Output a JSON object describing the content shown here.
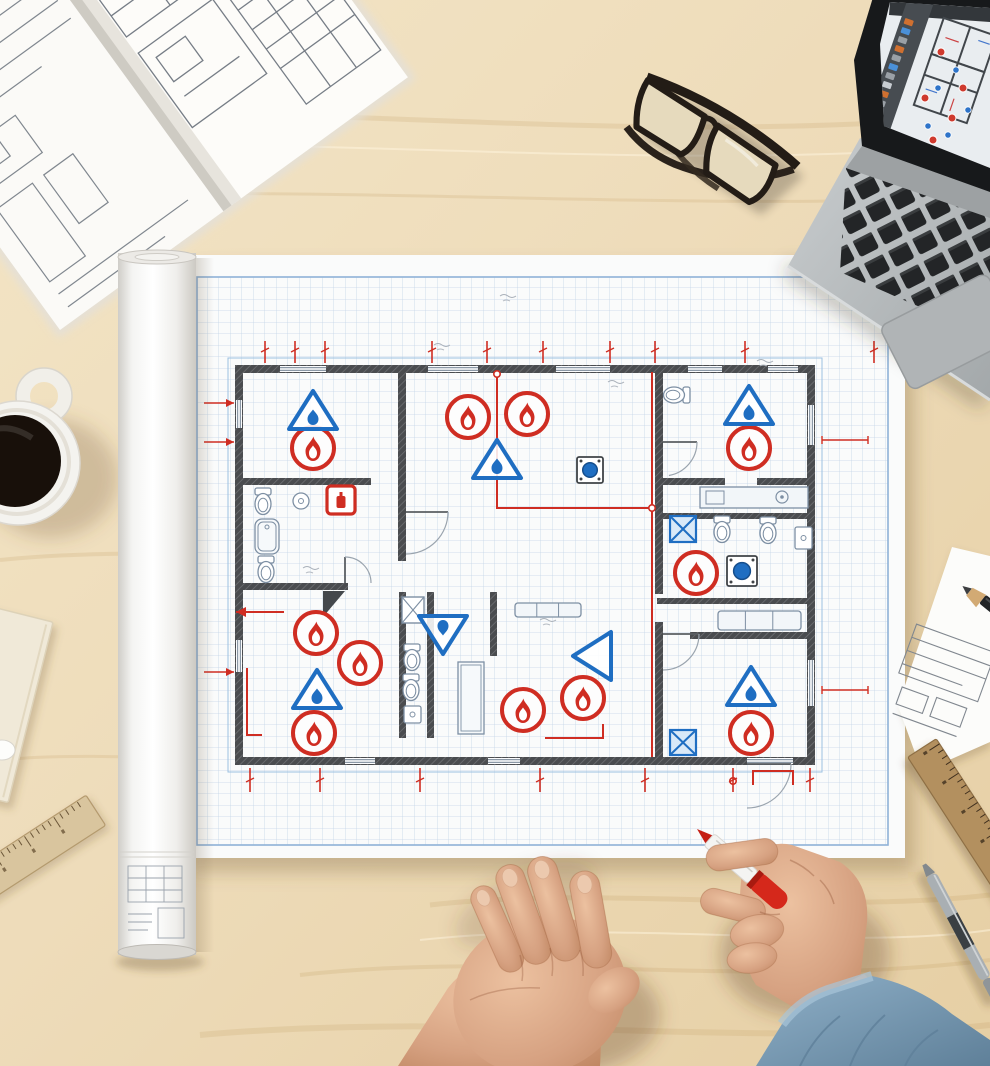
{
  "scene": {
    "description": "Top-down photograph of an architect's desk: fire-safety floor plan on grid paper, open specification book, laptop with CAD software, glasses, coffee mug, rolled blueprint tube, rulers, pencils, and two hands (one holding a red marker).",
    "visible_text": []
  },
  "palette": {
    "desk": "#eedcba",
    "desk_light": "#f5e8cb",
    "desk_dark": "#e2cba0",
    "paper": "#fafbfb",
    "grid": "#c5d5e7",
    "frame_blue": "#8fb2d8",
    "wall": "#4a4c4f",
    "wall_hatch": "#6e7073",
    "fixture": "#7d8fa3",
    "red": "#cf2d22",
    "blue": "#1f6ec2",
    "blue_fill": "#d9e9f8",
    "skin": "#d6a181",
    "skin_light": "#ecc1a0",
    "skin_shadow": "#bf8661",
    "denim": "#7fa0ba",
    "denim_dark": "#6d8fa8",
    "laptop_body": "#b7bbbd",
    "key": "#232527",
    "bezel": "#17191b",
    "screen_canvas": "#e9edf0",
    "screen_sidebar": "#474c51",
    "wood_ruler": "#d9c59e",
    "wood_ruler_dark": "#b3905f",
    "marker_red": "#d5281b",
    "pen_gray": "#a9afb3",
    "coffee": "#18100a",
    "mug": "#f4f3ef",
    "tube": "#f7f7f5",
    "book_paper": "#fbfaf7",
    "book_line": "#80878f"
  },
  "objects": [
    "open-specification-book",
    "eyeglasses",
    "laptop-with-cad-software",
    "coffee-mug",
    "rolled-blueprint-tube",
    "fire-safety-floor-plan-sheet",
    "cream-notepad",
    "wooden-ruler-left",
    "wooden-ruler-right",
    "technical-sheet-with-pencil",
    "gray-mechanical-pencil",
    "left-hand",
    "right-hand-holding-red-marker",
    "denim-sleeve"
  ],
  "floor_plan": {
    "sheet": {
      "x": 185,
      "y": 255,
      "w": 720,
      "h": 603
    },
    "frame": {
      "x": 197,
      "y": 277,
      "w": 691,
      "h": 568
    },
    "grid_size": 11.5,
    "symbol_counts": {
      "fire_alarm_circles": 11,
      "detector_triangles": 7,
      "extinguisher_boxes": 1,
      "shower_x_boxes": 2,
      "stoves": 2
    },
    "walls": [
      [
        235,
        365,
        580,
        8
      ],
      [
        235,
        365,
        8,
        400
      ],
      [
        807,
        365,
        8,
        400
      ],
      [
        235,
        757,
        580,
        8
      ],
      [
        398,
        365,
        8,
        196
      ],
      [
        655,
        365,
        8,
        115
      ],
      [
        235,
        478,
        136,
        7
      ],
      [
        235,
        583,
        113,
        7
      ],
      [
        399,
        592,
        7,
        146
      ],
      [
        427,
        592,
        7,
        146
      ],
      [
        490,
        592,
        7,
        64
      ],
      [
        663,
        478,
        62,
        7
      ],
      [
        757,
        478,
        58,
        7
      ],
      [
        657,
        513,
        158,
        6
      ],
      [
        657,
        598,
        158,
        6
      ],
      [
        655,
        480,
        8,
        114
      ],
      [
        655,
        622,
        8,
        135
      ],
      [
        690,
        632,
        125,
        7
      ]
    ],
    "windows": [
      [
        280,
        366,
        46,
        6
      ],
      [
        428,
        366,
        50,
        6
      ],
      [
        556,
        366,
        54,
        6
      ],
      [
        688,
        366,
        34,
        6
      ],
      [
        768,
        366,
        30,
        6
      ],
      [
        236,
        400,
        6,
        28
      ],
      [
        236,
        640,
        6,
        32
      ],
      [
        808,
        405,
        6,
        40
      ],
      [
        808,
        660,
        6,
        46
      ],
      [
        345,
        758,
        30,
        6
      ],
      [
        488,
        758,
        32,
        6
      ],
      [
        747,
        758,
        46,
        6
      ]
    ],
    "doors": [
      [
        345,
        583,
        26,
        -90,
        0
      ],
      [
        406,
        512,
        42,
        0,
        90
      ],
      [
        663,
        442,
        34,
        0,
        80
      ],
      [
        663,
        634,
        36,
        0,
        90
      ],
      [
        747,
        764,
        44,
        0,
        90
      ]
    ],
    "door_wedge": [
      323,
      591,
      345,
      591,
      323,
      617
    ],
    "fire_alarms": [
      [
        313,
        448
      ],
      [
        468,
        417
      ],
      [
        527,
        414
      ],
      [
        749,
        448
      ],
      [
        696,
        573
      ],
      [
        316,
        633
      ],
      [
        360,
        663
      ],
      [
        314,
        733
      ],
      [
        523,
        710
      ],
      [
        583,
        698
      ],
      [
        751,
        733
      ]
    ],
    "triangles": [
      [
        313,
        412,
        0,
        0
      ],
      [
        497,
        461,
        0,
        0
      ],
      [
        749,
        407,
        0,
        0
      ],
      [
        317,
        691,
        0,
        0
      ],
      [
        443,
        633,
        180,
        0
      ],
      [
        594,
        656,
        270,
        1
      ],
      [
        751,
        688,
        0,
        0
      ]
    ],
    "ext_boxes": [
      [
        341,
        500
      ]
    ],
    "x_boxes_blue": [
      [
        670,
        516,
        26,
        26
      ],
      [
        670,
        730,
        26,
        25
      ]
    ],
    "x_boxes_gray": [
      [
        402,
        597,
        22,
        26
      ]
    ],
    "stoves": [
      [
        727,
        556,
        30
      ],
      [
        577,
        457,
        26
      ]
    ],
    "toilets": [
      [
        263,
        502,
        0
      ],
      [
        266,
        570,
        0
      ],
      [
        412,
        658,
        0
      ],
      [
        411,
        688,
        0
      ],
      [
        676,
        395,
        90
      ],
      [
        722,
        530,
        0
      ],
      [
        768,
        531,
        0
      ]
    ],
    "sinks_round": [
      [
        301,
        501
      ]
    ],
    "sink_rects": [
      [
        404,
        706,
        17,
        17
      ],
      [
        795,
        527,
        17,
        22
      ]
    ],
    "tubs": [
      [
        255,
        519,
        24,
        35
      ]
    ],
    "counters": [
      [
        700,
        487,
        108,
        21
      ]
    ],
    "benches": [
      [
        515,
        603,
        66,
        14
      ],
      [
        718,
        611,
        83,
        19
      ]
    ],
    "tables": [
      [
        458,
        662,
        26,
        72
      ]
    ],
    "red_lines": [
      "497,374 497,508 652,508",
      "652,372 652,757",
      "236,612 284,612",
      "247,668 247,735 262,735",
      "545,738 603,738 603,724",
      "753,785 753,771 793,771 793,785"
    ],
    "red_nodes": [
      [
        497,
        374
      ],
      [
        652,
        508
      ],
      [
        733,
        781
      ]
    ],
    "dim_top_x": [
      265,
      295,
      325,
      432,
      487,
      543,
      610,
      655,
      745,
      874
    ],
    "dim_bottom_x": [
      250,
      320,
      420,
      540,
      645,
      733,
      810
    ],
    "dim_left_y": [
      403,
      442,
      672
    ],
    "dim_right": [
      [
        822,
        440,
        868,
        440
      ],
      [
        822,
        690,
        868,
        690
      ]
    ],
    "sketch_marks": [
      [
        500,
        296
      ],
      [
        608,
        382
      ],
      [
        757,
        361
      ],
      [
        303,
        568
      ],
      [
        540,
        620
      ],
      [
        434,
        345
      ]
    ]
  },
  "laptop": {
    "screen": {
      "sidebar_icon_colors": [
        "#d07030",
        "#4a90d9",
        "#9aa0a6",
        "#d07030",
        "#9aa0a6",
        "#4a90d9",
        "#9aa0a6",
        "#c8cdd2",
        "#d07030",
        "#9aa0a6",
        "#4a90d9",
        "#9aa0a6"
      ],
      "red_markers": [
        [
          941,
          52
        ],
        [
          925,
          98
        ],
        [
          952,
          118
        ],
        [
          933,
          140
        ],
        [
          963,
          88
        ]
      ],
      "blue_markers": [
        [
          956,
          70
        ],
        [
          938,
          88
        ],
        [
          968,
          110
        ],
        [
          928,
          126
        ],
        [
          948,
          135
        ]
      ]
    }
  }
}
